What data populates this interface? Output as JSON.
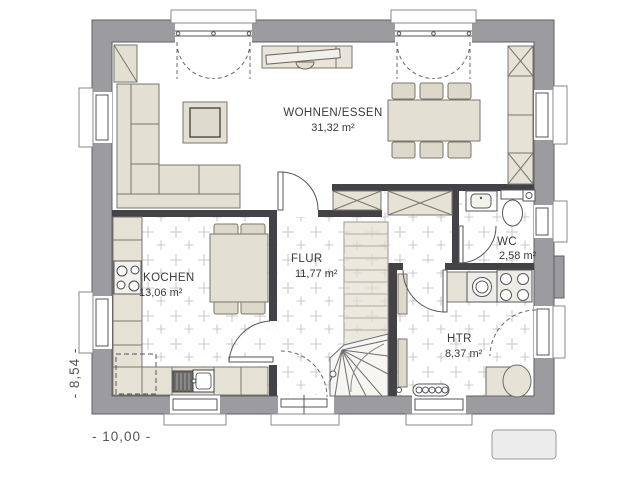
{
  "plan": {
    "rooms": [
      {
        "id": "wohnen-essen",
        "name": "WOHNEN/ESSEN",
        "area": "31,32 m²"
      },
      {
        "id": "kochen",
        "name": "KOCHEN",
        "area": "13,06 m²"
      },
      {
        "id": "flur",
        "name": "FLUR",
        "area": "11,77 m²"
      },
      {
        "id": "wc",
        "name": "WC",
        "area": "2,58 m²"
      },
      {
        "id": "htr",
        "name": "HTR",
        "area": "8,37 m²"
      }
    ],
    "dimensions": {
      "width": "- 10,00 -",
      "height": "- 8,54 -"
    },
    "colors": {
      "exterior_wall": "#9b9ba0",
      "interior_wall": "#434347",
      "furniture_fill": "#e3dfd3",
      "floor_tile_mark": "#c9c9c9",
      "background": "#ffffff"
    }
  }
}
